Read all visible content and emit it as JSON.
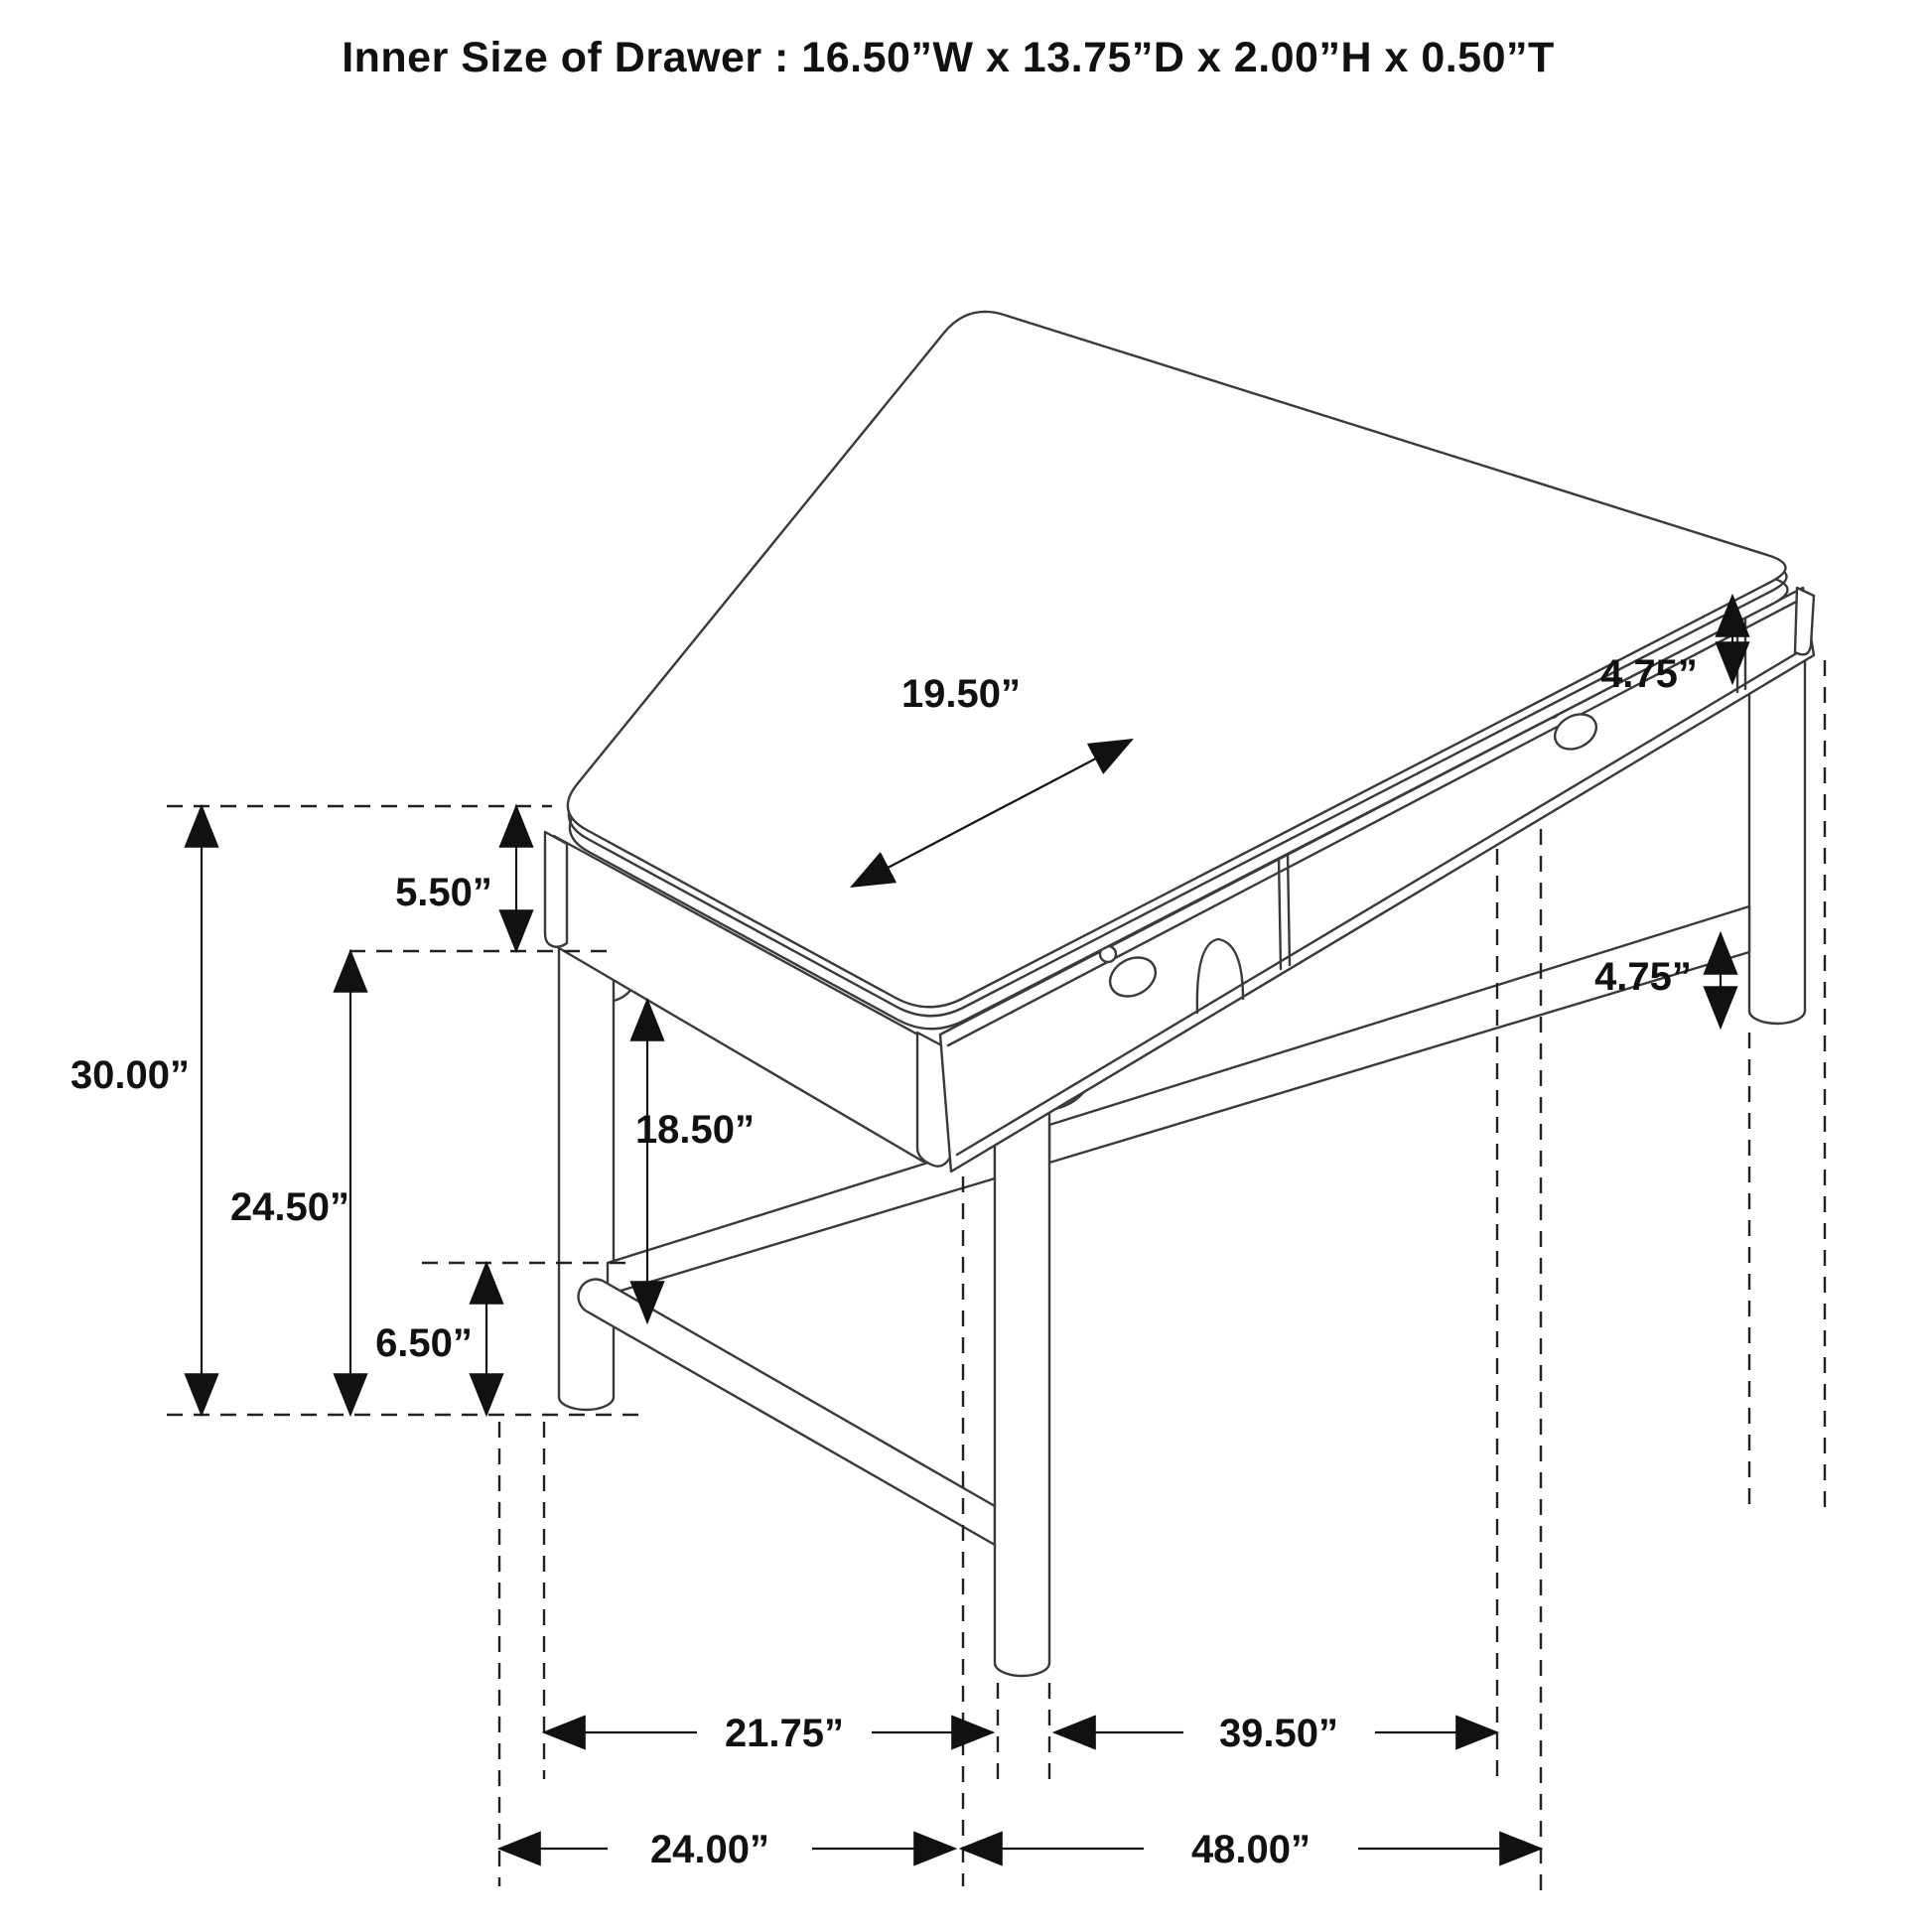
{
  "title": "Inner Size of Drawer : 16.50”W x 13.75”D x 2.00”H x 0.50”T",
  "labels": {
    "overall_height": "30.00”",
    "height_under_apron": "24.50”",
    "apron_height": "5.50”",
    "stretcher_height": "6.50”",
    "knee_clearance": "18.50”",
    "drawer_width": "19.50”",
    "top_right_height": "4.75”",
    "leg_bottom_height": "4.75”",
    "left_leg_span": "21.75”",
    "front_leg_span": "39.50”",
    "overall_depth": "24.00”",
    "overall_width": "48.00”"
  },
  "colors": {
    "line": "#3a3a3a",
    "dimension": "#111111",
    "background": "#ffffff"
  }
}
